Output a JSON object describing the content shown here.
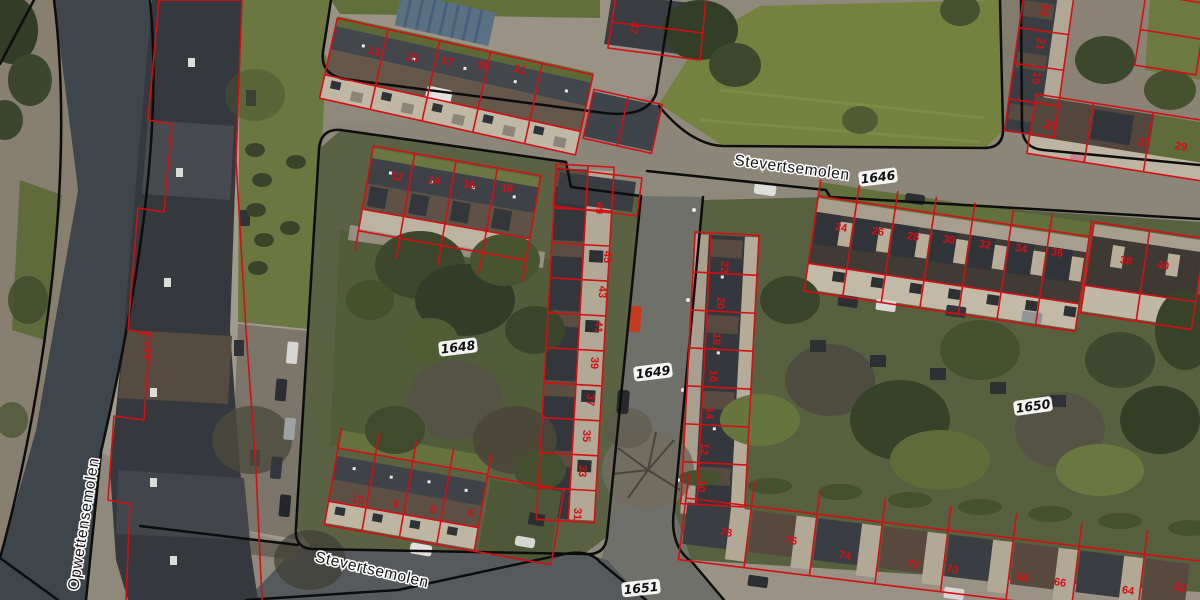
{
  "colors": {
    "boundary": "#0d0d0d",
    "cadastral": "#d40f14",
    "street_label": "#161616",
    "parcel_label": "#101010",
    "halo": "#ffffff"
  },
  "labels": {
    "street_labels": [
      {
        "text": "Stevertsemolen",
        "x": 792,
        "y": 168,
        "r": 7.5
      },
      {
        "text": "Stevertsemolen",
        "x": 372,
        "y": 570,
        "r": 13
      },
      {
        "text": "Opwettensemolen",
        "x": 84,
        "y": 524,
        "r": -81
      }
    ],
    "parcel_labels": [
      {
        "text": "1646",
        "x": 878,
        "y": 177,
        "r": -7
      },
      {
        "text": "1648",
        "x": 458,
        "y": 347,
        "r": -7
      },
      {
        "text": "1649",
        "x": 653,
        "y": 372,
        "r": -7
      },
      {
        "text": "1650",
        "x": 1033,
        "y": 406,
        "r": -8
      },
      {
        "text": "1651",
        "x": 641,
        "y": 588,
        "r": -6
      }
    ],
    "range_label": {
      "text": "2-144",
      "x": 146,
      "y": 345,
      "r": 86
    },
    "house_numbers": [
      {
        "n": "13",
        "x": 374,
        "y": 52,
        "r": 12
      },
      {
        "n": "15",
        "x": 412,
        "y": 58,
        "r": 12
      },
      {
        "n": "17",
        "x": 447,
        "y": 62,
        "r": 12
      },
      {
        "n": "19",
        "x": 483,
        "y": 66,
        "r": 12
      },
      {
        "n": "21",
        "x": 520,
        "y": 70,
        "r": 12
      },
      {
        "n": "47",
        "x": 634,
        "y": 28,
        "r": 102
      },
      {
        "n": "12",
        "x": 397,
        "y": 177,
        "r": 10
      },
      {
        "n": "14",
        "x": 434,
        "y": 181,
        "r": 10
      },
      {
        "n": "16",
        "x": 469,
        "y": 185,
        "r": 10
      },
      {
        "n": "18",
        "x": 507,
        "y": 189,
        "r": 10
      },
      {
        "n": "49",
        "x": 599,
        "y": 208,
        "r": 92
      },
      {
        "n": "45",
        "x": 607,
        "y": 257,
        "r": 92
      },
      {
        "n": "43",
        "x": 602,
        "y": 292,
        "r": 92
      },
      {
        "n": "41",
        "x": 598,
        "y": 327,
        "r": 92
      },
      {
        "n": "39",
        "x": 594,
        "y": 363,
        "r": 92
      },
      {
        "n": "37",
        "x": 590,
        "y": 400,
        "r": 92
      },
      {
        "n": "35",
        "x": 586,
        "y": 436,
        "r": 92
      },
      {
        "n": "33",
        "x": 582,
        "y": 471,
        "r": 92
      },
      {
        "n": "31",
        "x": 577,
        "y": 514,
        "r": 92
      },
      {
        "n": "10",
        "x": 358,
        "y": 500,
        "r": 10
      },
      {
        "n": "8",
        "x": 396,
        "y": 505,
        "r": 10
      },
      {
        "n": "6",
        "x": 433,
        "y": 510,
        "r": 10
      },
      {
        "n": "4",
        "x": 470,
        "y": 514,
        "r": 10
      },
      {
        "n": "22",
        "x": 724,
        "y": 267,
        "r": 93
      },
      {
        "n": "20",
        "x": 720,
        "y": 303,
        "r": 93
      },
      {
        "n": "18",
        "x": 716,
        "y": 339,
        "r": 93
      },
      {
        "n": "16",
        "x": 713,
        "y": 376,
        "r": 93
      },
      {
        "n": "14",
        "x": 709,
        "y": 413,
        "r": 93
      },
      {
        "n": "12",
        "x": 704,
        "y": 449,
        "r": 93
      },
      {
        "n": "10",
        "x": 701,
        "y": 486,
        "r": 93
      },
      {
        "n": "24",
        "x": 841,
        "y": 228,
        "r": 9
      },
      {
        "n": "26",
        "x": 878,
        "y": 232,
        "r": 9
      },
      {
        "n": "28",
        "x": 913,
        "y": 237,
        "r": 9
      },
      {
        "n": "30",
        "x": 949,
        "y": 240,
        "r": 9
      },
      {
        "n": "32",
        "x": 985,
        "y": 245,
        "r": 9
      },
      {
        "n": "34",
        "x": 1021,
        "y": 249,
        "r": 9
      },
      {
        "n": "36",
        "x": 1057,
        "y": 253,
        "r": 9
      },
      {
        "n": "38",
        "x": 1126,
        "y": 261,
        "r": 9
      },
      {
        "n": "40",
        "x": 1163,
        "y": 266,
        "r": 9
      },
      {
        "n": "25",
        "x": 1050,
        "y": 126,
        "r": 9
      },
      {
        "n": "27",
        "x": 1144,
        "y": 143,
        "r": 9
      },
      {
        "n": "29",
        "x": 1181,
        "y": 147,
        "r": 9
      },
      {
        "n": "23",
        "x": 1044,
        "y": 10,
        "r": 98
      },
      {
        "n": "21",
        "x": 1040,
        "y": 44,
        "r": 98
      },
      {
        "n": "19",
        "x": 1036,
        "y": 78,
        "r": 98
      },
      {
        "n": "78",
        "x": 726,
        "y": 533,
        "r": 9
      },
      {
        "n": "76",
        "x": 791,
        "y": 541,
        "r": 9
      },
      {
        "n": "74",
        "x": 845,
        "y": 556,
        "r": 9
      },
      {
        "n": "72",
        "x": 913,
        "y": 565,
        "r": 9
      },
      {
        "n": "70",
        "x": 952,
        "y": 570,
        "r": 9
      },
      {
        "n": "68",
        "x": 1022,
        "y": 578,
        "r": 9
      },
      {
        "n": "66",
        "x": 1060,
        "y": 583,
        "r": 9
      },
      {
        "n": "64",
        "x": 1128,
        "y": 591,
        "r": 9
      },
      {
        "n": "62",
        "x": 1180,
        "y": 588,
        "r": 9
      }
    ]
  }
}
